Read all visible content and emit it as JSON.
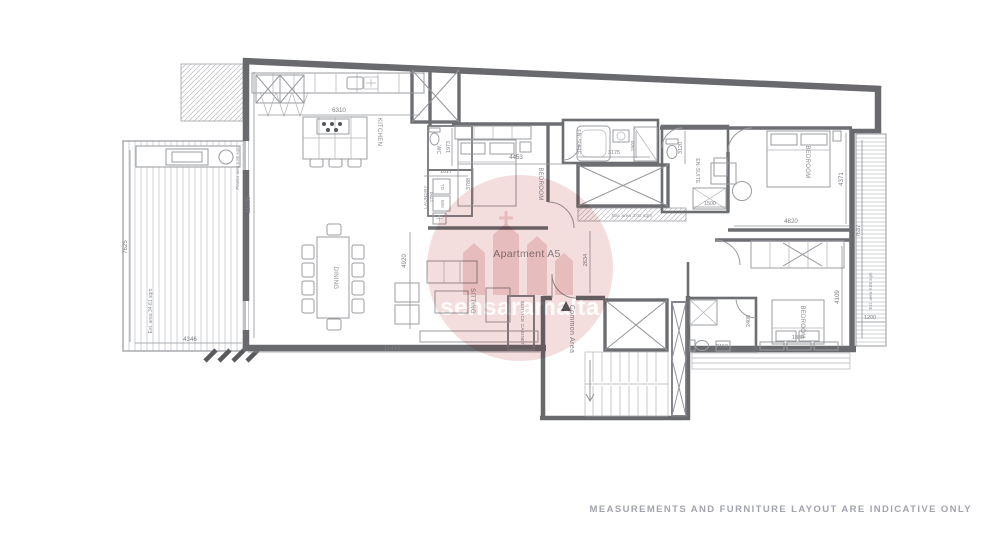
{
  "title": "Apartment A5",
  "watermark_text": "sensaramalta",
  "disclaimer": "MEASUREMENTS AND FURNITURE LAYOUT ARE INDICATIVE ONLY",
  "room_labels": {
    "kitchen": "KITCHEN",
    "dining": "DINING",
    "sitting": "SITTING",
    "bedroom1": "BEDROOM",
    "bedroom2": "BEDROOM",
    "bedroom3": "BEDROOM",
    "ensuite1": "EN-SUITE",
    "ensuite2": "EN-SUITE",
    "wc": "WC",
    "laundry": "LAUNDRY",
    "td": "TD",
    "wm": "WM",
    "service_cabinet": "SERVICE CABINET",
    "common_area": "Common Area"
  },
  "area_labels": {
    "terrace": "Ext. area 34.61 sqm",
    "planter": "Planter area 8.88 sqm",
    "shaft": "Ext. area 3.02 sqm",
    "balcony": "Ext. area 9.05 sqm"
  },
  "dimensions": {
    "kitchen_w": "6310",
    "left_wall": "11220",
    "terrace_h": "7625",
    "terrace_w": "4346",
    "wc_h": "1973",
    "laundry_w": "1617",
    "laundry_h": "1790",
    "bedroom1_w": "4453",
    "bedroom1_h": "3788",
    "ensuite1_w": "3175",
    "ensuite1_h": "1503",
    "ensuite2_h": "3120",
    "shower2_w": "1500",
    "sitting_h": "4920",
    "living_w": "11410",
    "corridor_h": "2634",
    "bedroom2_w": "4820",
    "bedroom2_h": "4371",
    "balcony_h": "7537",
    "balcony_w": "1200",
    "bedroom3_h": "4109",
    "bed3_w": "1880",
    "ensuite3_w": "2150",
    "ensuite3_h": "2400"
  }
}
